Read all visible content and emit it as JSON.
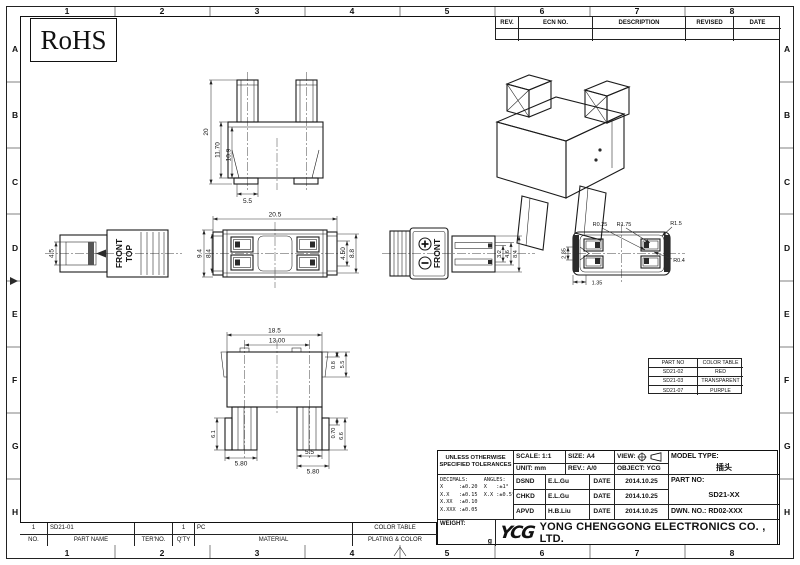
{
  "frame": {
    "columns": [
      "1",
      "2",
      "3",
      "4",
      "5",
      "6",
      "7",
      "8"
    ],
    "rows": [
      "A",
      "B",
      "C",
      "D",
      "E",
      "F",
      "G",
      "H"
    ]
  },
  "badges": {
    "rohs": "RoHS"
  },
  "revision_table": {
    "headers": [
      "REV.",
      "ECN NO.",
      "DESCRIPTION",
      "REVISED",
      "DATE"
    ]
  },
  "views": {
    "top": {
      "dims": [
        "20",
        "11.70",
        "10.9",
        "5.5"
      ]
    },
    "side": {
      "front": "FRONT",
      "top": "TOP",
      "dims": [
        "4.5"
      ]
    },
    "front": {
      "dims": [
        "20.5",
        "9.4",
        "8.4",
        "4.50",
        "8.8"
      ]
    },
    "face": {
      "front": "FRONT",
      "dims": [
        "3.2",
        "4.6",
        "8.4"
      ]
    },
    "mating": {
      "dims": [
        "R0.25",
        "R1.75",
        "R1.5",
        "R0.4",
        "2.35",
        "1.35"
      ]
    },
    "bottom": {
      "dims": [
        "18.5",
        "13.00",
        "0.8",
        "5.5",
        "6.1",
        "0.70",
        "6.6",
        "5.80",
        "5.5",
        "5.80"
      ]
    }
  },
  "color_table": {
    "headers": [
      "PART NO",
      "COLOR TABLE"
    ],
    "rows": [
      [
        "SD21-02",
        "RED"
      ],
      [
        "SD21-03",
        "TRANSPARENT"
      ],
      [
        "SD21-07",
        "PURPLE"
      ]
    ]
  },
  "tolerances": {
    "title1": "UNLESS OTHERWISE",
    "title2": "SPECIFIED TOLERANCES",
    "lines": [
      "DECIMALS:     ANGLES:",
      "X     :±0.20  X   :±1°",
      "X.X   :±0.15  X.X :±0.5°",
      "X.XX  :±0.10",
      "X.XXX :±0.05"
    ]
  },
  "title_block": {
    "scale_label": "SCALE:",
    "scale": "1:1",
    "size_label": "SIZE:",
    "size": "A4",
    "view_label": "VIEW:",
    "unit_label": "UNIT:",
    "unit": "mm",
    "rev_label": "REV.:",
    "rev": "A/0",
    "object_label": "OBJECT:",
    "object": "YCG",
    "rows": [
      {
        "role": "DSND",
        "name": "E.L.Gu",
        "date_label": "DATE",
        "date": "2014.10.25"
      },
      {
        "role": "CHKD",
        "name": "E.L.Gu",
        "date_label": "DATE",
        "date": "2014.10.25"
      },
      {
        "role": "APVD",
        "name": "H.B.Liu",
        "date_label": "DATE",
        "date": "2014.10.25"
      }
    ],
    "model_type_label": "MODEL TYPE:",
    "model_type": "插头",
    "part_no_label": "PART NO:",
    "part_no": "SD21-XX",
    "dwn_no": "DWN. NO.: RD02-XXX",
    "weight_label": "WEIGHT:",
    "weight_unit": "g"
  },
  "parts_table": {
    "row": [
      "1",
      "SD21-01",
      "",
      "1",
      "PC",
      "COLOR TABLE"
    ],
    "headers": [
      "NO.",
      "PART NAME",
      "TER'NO.",
      "Q'TY",
      "MATERIAL",
      "PLATING & COLOR"
    ]
  },
  "company": {
    "logo": "YCG",
    "name": "YONG CHENGGONG ELECTRONICS CO. , LTD."
  }
}
